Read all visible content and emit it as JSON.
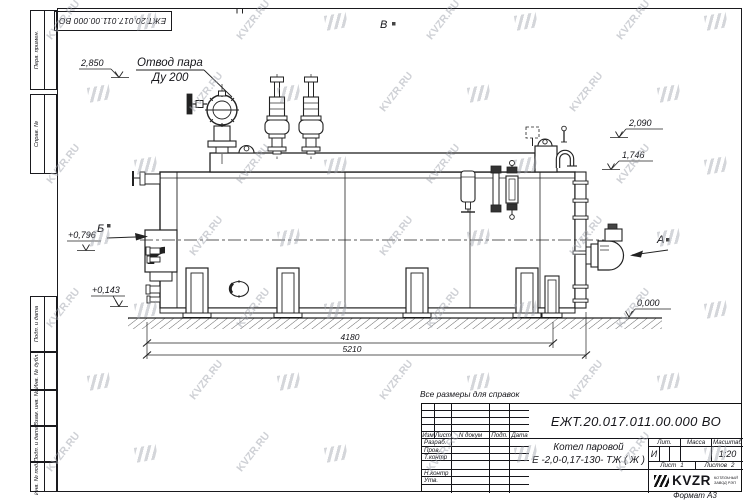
{
  "frame": {
    "left_labels": [
      "Перв. примен.",
      "Справ. №",
      "Подп. и дата",
      "Инв. № дубл.",
      "Взам. инв. №",
      "Подп. и дата",
      "Инв. № подл."
    ],
    "top_doc_number": "ЕЖТ.20.017.011.00.000  ВО",
    "format_label": "Формат А3"
  },
  "note": "Все размеры для справок",
  "watermark": {
    "text": "KVZR.RU"
  },
  "drawing": {
    "steam_outlet_line1": "Отвод пара",
    "steam_outlet_line2": "Ду 200",
    "elev_top": "2,850",
    "elev_2090": "2,090",
    "elev_1746": "1,746",
    "elev_0796": "+0,796",
    "elev_0143": "+0,143",
    "elev_zero": "0,000",
    "dim_inner": "4180",
    "dim_total": "5210",
    "view_a": "А",
    "view_b": "Б",
    "view_v": "В"
  },
  "title_block": {
    "doc_number": "ЕЖТ.20.017.011.00.000  ВО",
    "name_line1": "Котел паровой",
    "name_line2": "Е -2,0-0,17-130- ТЖ ( Ж )",
    "cols": {
      "izm": "Изм",
      "list": "Лист",
      "ndok": "N докум",
      "podp": "Подп.",
      "data": "Дата"
    },
    "rows": [
      "Разраб.",
      "Пров.",
      "Т.контр",
      "",
      "Н.контр",
      "Утв."
    ],
    "lit_label": "Лит.",
    "massa_label": "Масса",
    "masshtab_label": "Масштаб",
    "lit_value": "И",
    "masshtab_value": "1:20",
    "list_label": "Лист",
    "list_value": "1",
    "listov_label": "Листов",
    "listov_value": "2",
    "logo": {
      "text": "KVZR",
      "sub1": "КОТЕЛЬНЫЙ",
      "sub2": "ЗАВОД РЭП"
    }
  }
}
